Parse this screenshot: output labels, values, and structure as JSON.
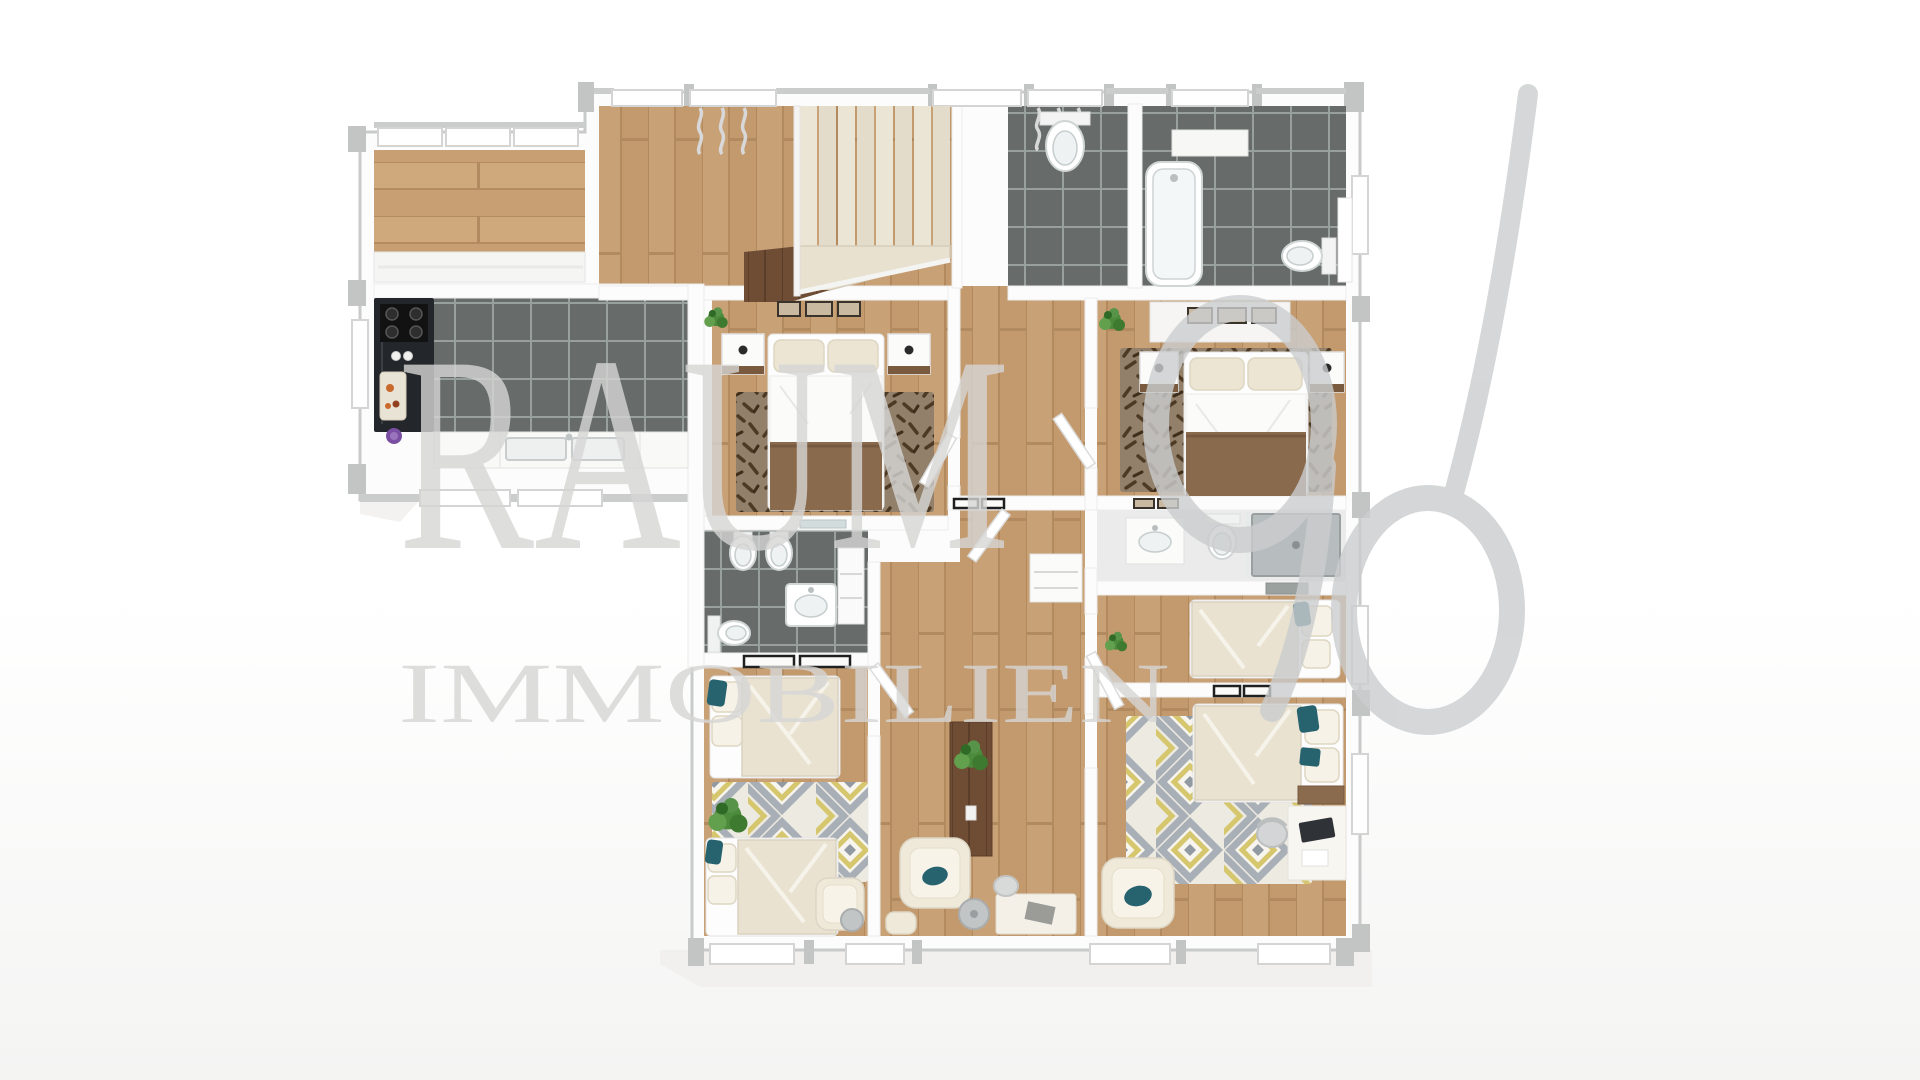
{
  "watermark": {
    "brand": "RAUM",
    "number": "96",
    "subtitle": "IMMOBILIEN"
  },
  "scene": {
    "type": "3d-floor-plan-top-view",
    "floor_material_main": "light oak parquet",
    "floor_material_wet_rooms": "dark gray tile"
  },
  "colors": {
    "background": "#ffffff",
    "foundation": "#f1f0ee",
    "wall": "#fcfcfc",
    "wall_outline": "#c9caca",
    "wall_cap": "#c3c4c4",
    "wood_floor": "#c9a176",
    "wood_floor_dark": "#b28a5e",
    "wood_dark": "#6f4d34",
    "tile_gray": "#676c6a",
    "tile_grout": "#97a09d",
    "stair_tread": "#eae3d2",
    "counter_black": "#23262a",
    "rug_dark_base": "#92806a",
    "rug_dark_mark": "#4e3a24",
    "rug_diamond_bg": "#edebe1",
    "rug_diamond_gray": "#a9afb7",
    "rug_diamond_yellow": "#d6c76f",
    "duvet_cream": "#e9e2d1",
    "pillow_cream": "#ece5d4",
    "blanket_brown": "#8a6a4c",
    "accent_teal": "#27626f",
    "plant_green": "#4c8a3c",
    "watermark_gray": "#d6d6d5",
    "watermark_digit": "#cbcdce"
  }
}
